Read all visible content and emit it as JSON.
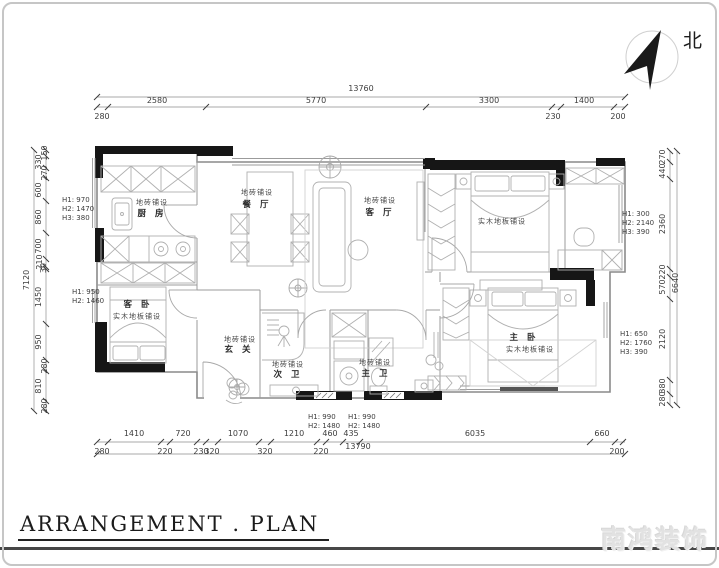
{
  "compass": {
    "label": "北"
  },
  "title": "ARRANGEMENT  . PLAN",
  "watermark": "南鸿装饰",
  "dims": {
    "top": {
      "total": "13760",
      "seg": [
        "2580",
        "5770",
        "3300",
        "1400"
      ],
      "edge": [
        "280",
        "230",
        "200"
      ]
    },
    "bottom": {
      "total": "13790",
      "seg": [
        "1410",
        "720",
        "1070",
        "1210",
        "460",
        "435",
        "6035",
        "660"
      ],
      "edge": [
        "280",
        "220",
        "230",
        "320",
        "320",
        "220",
        "200"
      ]
    },
    "left": {
      "total": "7120",
      "seg": [
        "150",
        "330",
        "270",
        "600",
        "860",
        "700",
        "210",
        "30",
        "1450",
        "950",
        "280",
        "810",
        "280"
      ]
    },
    "right": {
      "total": "6640",
      "seg": [
        "270",
        "440",
        "2360",
        "220",
        "570",
        "2120",
        "380",
        "280"
      ]
    }
  },
  "rooms": {
    "kitchen": {
      "name": "厨 房",
      "floor": "地砖铺设"
    },
    "dining": {
      "name": "餐 厅",
      "floor": "地砖铺设"
    },
    "living": {
      "name": "客 厅",
      "floor": "地砖铺设"
    },
    "bedroom2": {
      "floor": "实木地板铺设"
    },
    "guest": {
      "name": "客 卧",
      "floor": "实木地板铺设"
    },
    "foyer": {
      "name": "玄 关",
      "floor": "地砖铺设"
    },
    "bath2": {
      "name": "次 卫",
      "floor": "地砖铺设"
    },
    "bath1": {
      "name": "主 卫",
      "floor": "地砖铺设"
    },
    "master": {
      "name": "主 卧",
      "floor": "实木地板铺设"
    }
  },
  "ann": {
    "kitchen": [
      "H1: 970",
      "H2: 1470",
      "H3: 380"
    ],
    "guest": [
      "H1: 950",
      "H2: 1460"
    ],
    "study": [
      "H1: 300",
      "H2: 2140",
      "H3: 390"
    ],
    "master": [
      "H1: 650",
      "H2: 1760",
      "H3: 390"
    ],
    "bath2": [
      "H1: 990",
      "H2: 1480"
    ],
    "bath1": [
      "H1: 990",
      "H2: 1480"
    ]
  }
}
